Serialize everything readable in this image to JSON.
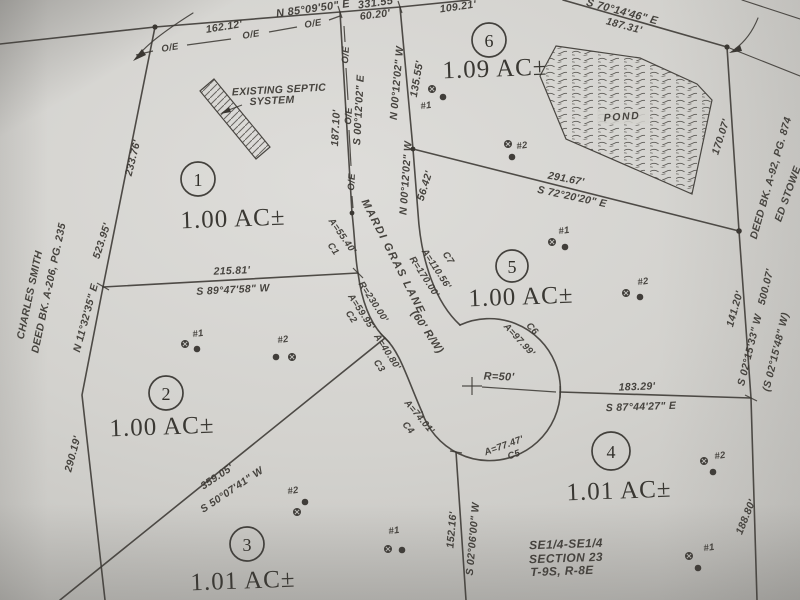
{
  "colors": {
    "paper": "#d3d2ce",
    "ink": "#3a3732"
  },
  "lots": [
    {
      "number": "1",
      "area": "1.00 AC±"
    },
    {
      "number": "2",
      "area": "1.00 AC±"
    },
    {
      "number": "3",
      "area": "1.01 AC±"
    },
    {
      "number": "4",
      "area": "1.01 AC±"
    },
    {
      "number": "5",
      "area": "1.00 AC±"
    },
    {
      "number": "6",
      "area": "1.09 AC±"
    }
  ],
  "adjoiners": {
    "west_owner": "CHARLES SMITH",
    "west_deed": "DEED BK. A-206, PG. 235",
    "east_owner": "ED STOWE",
    "east_deed": "DEED BK. A-92, PG. 874"
  },
  "road": {
    "name": "MARDI GRAS LANE",
    "right_of_way": "(60' R/W)",
    "culdesac_radius": "R=50'"
  },
  "pond": {
    "label": "POND"
  },
  "septic": {
    "line1": "EXISTING SEPTIC",
    "line2": "SYSTEM"
  },
  "section_note": {
    "line1": "SE1/4-SE1/4",
    "line2": "SECTION 23",
    "line3": "T-9S, R-8E"
  },
  "utility_mark": "O/E",
  "boundaries": {
    "north": {
      "bearing": "N 85°09'50\" E",
      "distance": "331.55'",
      "seg1": "162.12'",
      "seg2": "60.20'",
      "seg3": "109.21'"
    },
    "northeast": {
      "bearing": "S 70°14'46\" E",
      "distance": "187.31'"
    },
    "west": {
      "seg1": "233.76'",
      "distance": "523.95'",
      "bearing": "N 11°32'35\" E",
      "seg2": "290.19'"
    },
    "east": {
      "seg1": "170.07'",
      "seg2": "141.20'",
      "bearing": "S 02°15'33\" W",
      "distance": "500.07'",
      "record": "(S 02°15'48\" W)",
      "seg3": "188.80'"
    },
    "lot1_lot2": {
      "distance": "215.81'",
      "bearing": "S 89°47'58\" W"
    },
    "lot2_lot3": {
      "distance": "359.05'",
      "bearing": "S 50°07'41\" W"
    },
    "lot3_lot4": {
      "distance": "152.16'",
      "bearing": "S 02°06'00\" W"
    },
    "lot4_lot5": {
      "distance": "183.29'",
      "bearing": "S 87°44'27\" E"
    },
    "lot5_lot6": {
      "distance": "291.67'",
      "bearing": "S 72°20'20\" E"
    },
    "road_west": {
      "bearing": "S 00°12'02\" E",
      "distance": "187.10'"
    },
    "road_east_a": {
      "bearing": "N 00°12'02\" W",
      "distance": "135.55'"
    },
    "road_east_b": {
      "bearing": "N 00°12'02\" W",
      "distance": "56.42'"
    }
  },
  "curves": {
    "c1": {
      "arc": "A=55.40'",
      "id": "C1"
    },
    "c2": {
      "arc": "A=59.95'",
      "radius": "R=230.00'",
      "id": "C2"
    },
    "c3": {
      "arc": "A=40.80'",
      "id": "C3"
    },
    "c4": {
      "arc": "A=74.01'",
      "id": "C4"
    },
    "c5": {
      "arc": "A=77.47'",
      "id": "C5"
    },
    "c6": {
      "arc": "A=97.99'",
      "id": "C6"
    },
    "c7": {
      "arc": "A=110.56'",
      "radius": "R=170.00'",
      "id": "C7"
    }
  },
  "test_holes": {
    "m1": "#1",
    "m2": "#2",
    "m3": "#1",
    "m4": "#2",
    "m5": "#1",
    "m6": "#2",
    "m7": "#2",
    "m8": "#1",
    "m9": "#2",
    "m10": "#1"
  }
}
